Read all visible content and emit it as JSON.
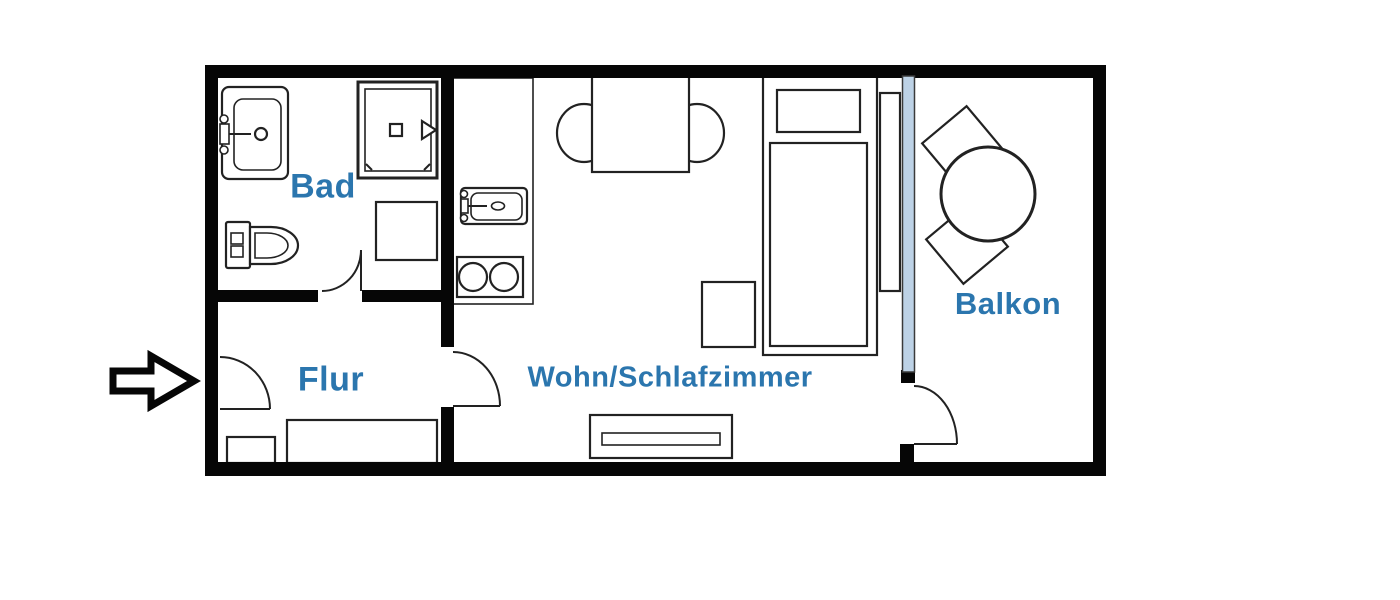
{
  "floor_plan": {
    "type": "apartment-floor-plan",
    "rooms": {
      "bad": {
        "label": "Bad"
      },
      "flur": {
        "label": "Flur"
      },
      "wohn_schlafzimmer": {
        "label": "Wohn/Schlafzimmer"
      },
      "balkon": {
        "label": "Balkon"
      }
    },
    "fixtures": [
      "entrance-arrow",
      "entrance-door",
      "washbasin",
      "shower",
      "toilet",
      "washing-machine",
      "bathroom-door",
      "kitchen-counter",
      "kitchen-sink",
      "stove",
      "dining-table",
      "dining-chairs",
      "room-door",
      "bed",
      "pillow",
      "nightstand",
      "wardrobe",
      "sideboard",
      "hall-cabinet",
      "shoe-cabinet",
      "balcony-window",
      "balcony-door",
      "balcony-table",
      "balcony-chairs"
    ],
    "colors": {
      "wall": "#060606",
      "furniture_line": "#222222",
      "room_label": "#2b76ae",
      "window_glass": "#bdd2e6"
    }
  }
}
